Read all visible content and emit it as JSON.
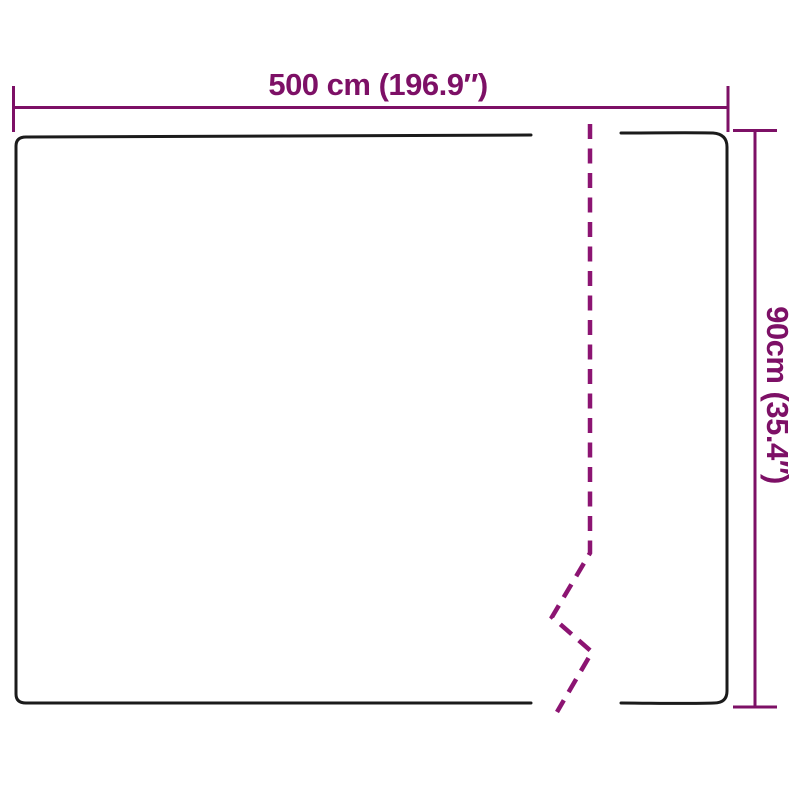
{
  "colors": {
    "background": "#ffffff",
    "outline": "#1b1b1b",
    "dimension": "#7d1066",
    "break_line": "#8c1472"
  },
  "diagram": {
    "width_label": "500 cm (196.9″)",
    "height_label": "90cm (35.4″)"
  }
}
